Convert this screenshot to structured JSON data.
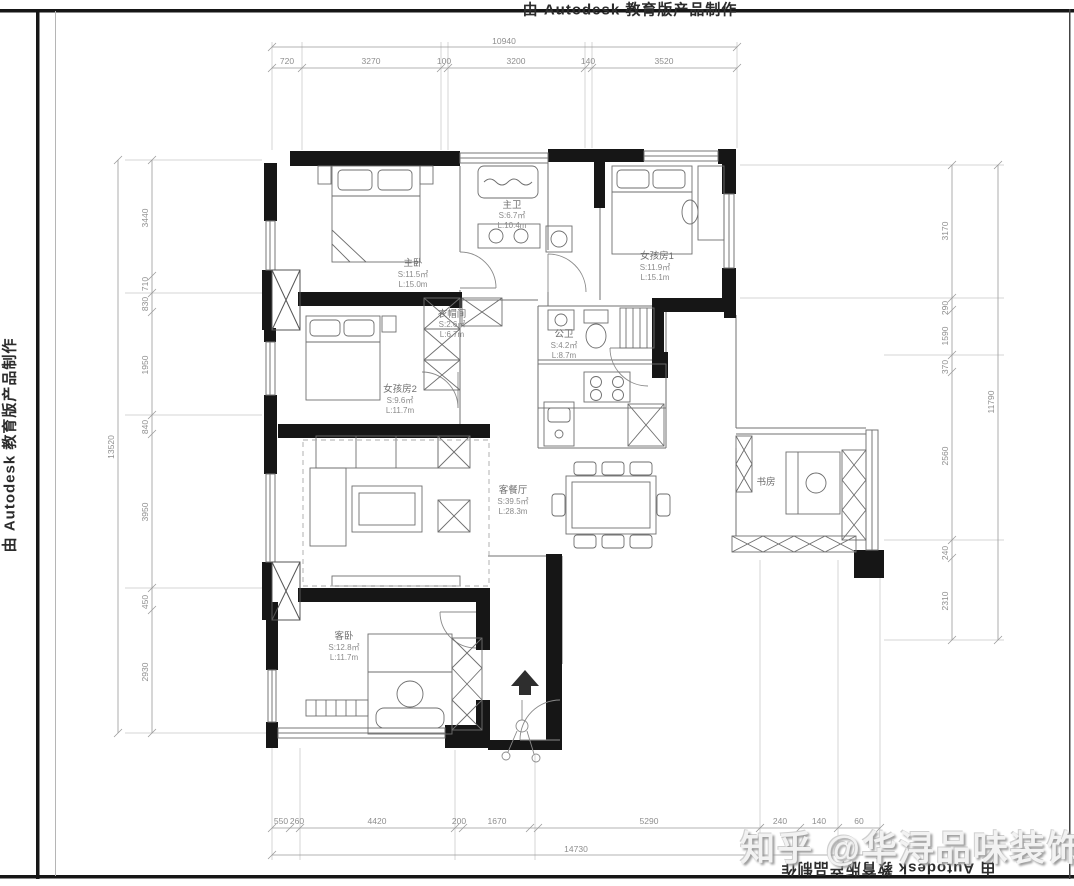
{
  "watermarks": {
    "top": "由 Autodesk 教育版产品制作",
    "left": "由 Autodesk 教育版产品制作",
    "bottom": "由 Autodesk 教育版产品制作",
    "brand": "知乎 @华浔品味装饰"
  },
  "rooms": {
    "master_bedroom": {
      "name": "主卧",
      "area": "S:11.5㎡",
      "length": "L:15.0m"
    },
    "master_bath": {
      "name": "主卫",
      "area": "S:6.7㎡",
      "length": "L:10.4m"
    },
    "girl1": {
      "name": "女孩房1",
      "area": "S:11.9㎡",
      "length": "L:15.1m"
    },
    "cloak": {
      "name": "衣帽间",
      "area": "S:2.6㎡",
      "length": "L:6.7m"
    },
    "public_bath": {
      "name": "公卫",
      "area": "S:4.2㎡",
      "length": "L:8.7m"
    },
    "girl2": {
      "name": "女孩房2",
      "area": "S:9.6㎡",
      "length": "L:11.7m"
    },
    "living": {
      "name": "客餐厅",
      "area": "S:39.5㎡",
      "length": "L:28.3m"
    },
    "study": {
      "name": "书房"
    },
    "guest": {
      "name": "客卧",
      "area": "S:12.8㎡",
      "length": "L:11.7m"
    }
  },
  "dimensions": {
    "top": {
      "total": "10940",
      "segments": [
        "720",
        "3270",
        "100",
        "3200",
        "140",
        "3520"
      ]
    },
    "bottom": {
      "total": "14730",
      "segments": [
        "550",
        "260",
        "4420",
        "200",
        "1670",
        "5290",
        "240",
        "140",
        "60"
      ]
    },
    "left": {
      "total": "13520",
      "segments": [
        "3440",
        "710",
        "830",
        "1950",
        "840",
        "3950",
        "450",
        "2930"
      ]
    },
    "right": {
      "total": "11790",
      "segments": [
        "3170",
        "290",
        "1590",
        "370",
        "2560",
        "240",
        "2310"
      ]
    }
  }
}
